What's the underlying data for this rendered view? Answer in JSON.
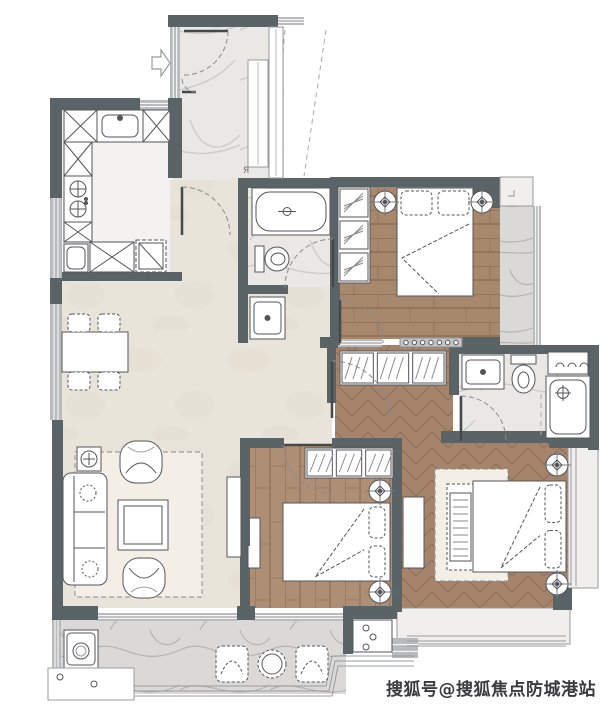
{
  "watermark": {
    "text": "搜狐号@搜狐焦点防城港站",
    "x": 386,
    "y": 695,
    "size": 17,
    "color": "#3a3a3e"
  },
  "label_ya": {
    "text": "Я",
    "x": 243,
    "y": 173,
    "size": 9,
    "color": "#6a6b6d"
  },
  "palette": {
    "wall": "#5a6467",
    "wallLight": "#b9babb",
    "stroke": "#55565a",
    "doorArc": "#8a8b8d",
    "dash": "#a9aaac",
    "white": "#ffffff",
    "beige": "#e9e4da",
    "kitchenFloor": "#f3f2f1",
    "sillFill": "#f1efed"
  },
  "plan": {
    "width": 603,
    "height": 707,
    "floors": [
      {
        "name": "entry-hall-floor",
        "kind": "marble",
        "x": 172,
        "y": 27,
        "w": 112,
        "h": 155
      },
      {
        "name": "living-dining-floor",
        "kind": "beige",
        "x": 62,
        "y": 180,
        "w": 270,
        "h": 428
      },
      {
        "name": "kitchen-floor",
        "kind": "kitchen",
        "x": 62,
        "y": 107,
        "w": 108,
        "h": 167
      },
      {
        "name": "bath-main-floor",
        "kind": "marble",
        "x": 248,
        "y": 186,
        "w": 84,
        "h": 101
      },
      {
        "name": "bedroom1-floor",
        "kind": "wood_h",
        "x": 338,
        "y": 185,
        "w": 162,
        "h": 154
      },
      {
        "name": "bedroom1-balcony-floor",
        "kind": "marble_gray",
        "x": 500,
        "y": 206,
        "w": 34,
        "h": 139
      },
      {
        "name": "corridor-floor",
        "kind": "herringbone",
        "x": 335,
        "y": 345,
        "w": 118,
        "h": 95
      },
      {
        "name": "master-bath-floor",
        "kind": "marble",
        "x": 459,
        "y": 352,
        "w": 130,
        "h": 88
      },
      {
        "name": "master-bedroom-floor",
        "kind": "herringbone",
        "x": 397,
        "y": 440,
        "w": 173,
        "h": 170
      },
      {
        "name": "bedroom2-floor",
        "kind": "wood_v",
        "x": 248,
        "y": 446,
        "w": 146,
        "h": 162
      },
      {
        "name": "balcony-floor",
        "kind": "marble_gray",
        "x": 60,
        "y": 618,
        "w": 286,
        "h": 76
      },
      {
        "name": "bay-window-bottom",
        "kind": "sillfloor",
        "x": 397,
        "y": 608,
        "w": 173,
        "h": 36
      },
      {
        "name": "bay-window-right",
        "kind": "sillfloor",
        "x": 568,
        "y": 446,
        "w": 30,
        "h": 142
      }
    ],
    "walls": [
      [
        168,
        15,
        110,
        12
      ],
      [
        50,
        98,
        90,
        12
      ],
      [
        50,
        110,
        12,
        88
      ],
      [
        50,
        278,
        12,
        26
      ],
      [
        52,
        420,
        11,
        200
      ],
      [
        52,
        606,
        46,
        14
      ],
      [
        237,
        606,
        18,
        14
      ],
      [
        343,
        606,
        54,
        13
      ],
      [
        343,
        606,
        10,
        48
      ],
      [
        168,
        98,
        14,
        80
      ],
      [
        62,
        272,
        120,
        9
      ],
      [
        238,
        178,
        96,
        10
      ],
      [
        238,
        186,
        10,
        102
      ],
      [
        238,
        285,
        50,
        9
      ],
      [
        238,
        285,
        10,
        58
      ],
      [
        330,
        177,
        10,
        168
      ],
      [
        340,
        177,
        133,
        10
      ],
      [
        473,
        177,
        27,
        31
      ],
      [
        320,
        337,
        18,
        11
      ],
      [
        460,
        337,
        40,
        11
      ],
      [
        327,
        348,
        9,
        55
      ],
      [
        240,
        438,
        44,
        10
      ],
      [
        332,
        438,
        65,
        10
      ],
      [
        240,
        448,
        10,
        160
      ],
      [
        392,
        438,
        10,
        174
      ],
      [
        441,
        431,
        110,
        12
      ],
      [
        449,
        345,
        10,
        50
      ],
      [
        449,
        345,
        142,
        9
      ],
      [
        588,
        345,
        11,
        105
      ],
      [
        549,
        438,
        50,
        10
      ],
      [
        553,
        588,
        19,
        22
      ]
    ],
    "lightWalls": [
      [
        278,
        17,
        26,
        8
      ],
      [
        138,
        100,
        38,
        10
      ],
      [
        50,
        198,
        12,
        80
      ],
      [
        50,
        304,
        12,
        116
      ],
      [
        97,
        613,
        140,
        8
      ],
      [
        253,
        613,
        90,
        8
      ],
      [
        533,
        206,
        8,
        139
      ],
      [
        338,
        339,
        44,
        8
      ],
      [
        392,
        638,
        26,
        20
      ],
      [
        52,
        620,
        9,
        56
      ],
      [
        170,
        27,
        10,
        71
      ]
    ],
    "glass": [
      "M407,636 H566",
      "M407,641 H566",
      "M407,646 H566",
      "M571,448 V586",
      "M576,448 V586"
    ],
    "railings": [
      "M55,686 L326,686 L332,656 L414,656",
      "M55,691 L329,691 L335,661 L414,661",
      "M55,696 L332,696 L338,666 L414,666"
    ],
    "doors": [
      {
        "name": "entry-door",
        "leaf": [
          184,
          31,
          228,
          31
        ],
        "arc": "M228,31 A44,44 0 0 1 184,75"
      },
      {
        "name": "entry-door-leaf2",
        "leaf": [
          182,
          92,
          196,
          92
        ],
        "arc": "M196,92 A14,14 0 0 1 182,78"
      },
      {
        "name": "kitchen-door",
        "leaf": [
          182,
          235,
          182,
          187
        ],
        "arc": "M182,187 A48,48 0 0 1 230,235"
      },
      {
        "name": "bath-door",
        "leaf": [
          333,
          287,
          333,
          239
        ],
        "arc": "M333,239 A48,48 0 0 0 285,287"
      },
      {
        "name": "bedroom1-door",
        "leaf": [
          340,
          343,
          340,
          300
        ],
        "arc": "M340,300 A43,43 0 0 1 383,343"
      },
      {
        "name": "corridor-door",
        "leaf": [
          332,
          418,
          332,
          361
        ],
        "arc": "M332,361 A57,57 0 0 1 389,418"
      },
      {
        "name": "bedroom2-door",
        "leaf": [
          332,
          445,
          284,
          445
        ],
        "arc": "M284,445 A48,48 0 0 0 332,493"
      },
      {
        "name": "master-bath-door",
        "leaf": [
          461,
          441,
          461,
          396
        ],
        "arc": "M461,396 A45,45 0 0 1 506,441"
      }
    ],
    "dashes": [
      [
        285,
        30,
        272,
        176
      ],
      [
        326,
        30,
        304,
        176
      ],
      [
        541,
        394,
        541,
        438
      ]
    ],
    "arrow": {
      "name": "entry-arrow",
      "points": "152,57 161,57 161,50 170,63 161,76 161,69 152,69"
    },
    "plants": [
      {
        "cx": 385,
        "cy": 202
      },
      {
        "cx": 482,
        "cy": 202
      },
      {
        "cx": 557,
        "cy": 465
      },
      {
        "cx": 557,
        "cy": 584
      },
      {
        "cx": 380,
        "cy": 491
      },
      {
        "cx": 380,
        "cy": 592
      }
    ],
    "furniture": [
      {
        "type": "xcab",
        "name": "kitchen-counter",
        "x": 64,
        "y": 110,
        "w": 33,
        "h": 32
      },
      {
        "type": "ksink",
        "name": "kitchen-sink",
        "x": 97,
        "y": 110,
        "w": 46,
        "h": 32
      },
      {
        "type": "xcab",
        "name": "kitchen-counter",
        "x": 143,
        "y": 110,
        "w": 27,
        "h": 32
      },
      {
        "type": "xcab",
        "name": "kitchen-counter",
        "x": 64,
        "y": 142,
        "w": 28,
        "h": 34
      },
      {
        "type": "stove",
        "name": "stove",
        "x": 64,
        "y": 176,
        "w": 28,
        "h": 46
      },
      {
        "type": "xcab",
        "name": "kitchen-counter",
        "x": 64,
        "y": 222,
        "w": 28,
        "h": 20
      },
      {
        "type": "appl",
        "name": "dishwasher",
        "x": 64,
        "y": 244,
        "w": 24,
        "h": 28
      },
      {
        "type": "xcab",
        "name": "kitchen-counter",
        "x": 90,
        "y": 242,
        "w": 44,
        "h": 30
      },
      {
        "type": "fridge",
        "name": "fridge",
        "x": 136,
        "y": 240,
        "w": 30,
        "h": 32
      },
      {
        "type": "cab",
        "name": "shoe-cabinet",
        "x": 248,
        "y": 60,
        "w": 20,
        "h": 107
      },
      {
        "type": "cab",
        "name": "entry-cabinet",
        "x": 269,
        "y": 27,
        "w": 14,
        "h": 151
      },
      {
        "type": "tub",
        "name": "bathtub",
        "x": 252,
        "y": 188,
        "w": 78,
        "h": 47
      },
      {
        "type": "toiletR",
        "name": "toilet",
        "x": 255,
        "y": 244,
        "w": 33,
        "h": 30
      },
      {
        "type": "vanity",
        "name": "washbasin",
        "x": 250,
        "y": 297,
        "w": 35,
        "h": 42
      },
      {
        "type": "wardV",
        "name": "bedroom1-wardrobe",
        "x": 338,
        "y": 187,
        "w": 32,
        "h": 96,
        "cells": 3
      },
      {
        "type": "bedT",
        "name": "bedroom1-bed",
        "x": 397,
        "y": 188,
        "w": 76,
        "h": 108
      },
      {
        "type": "track",
        "name": "sliding-door",
        "x": 400,
        "y": 338,
        "w": 62,
        "h": 9,
        "dots": 7
      },
      {
        "type": "sill",
        "name": "window-sill",
        "x": 500,
        "y": 177,
        "w": 33,
        "h": 29
      },
      {
        "type": "wardH",
        "name": "corridor-wardrobe",
        "x": 340,
        "y": 351,
        "w": 106,
        "h": 34,
        "cells": 3
      },
      {
        "type": "vanity",
        "name": "master-washbasin",
        "x": 462,
        "y": 355,
        "w": 42,
        "h": 34
      },
      {
        "type": "toiletD",
        "name": "master-toilet",
        "x": 511,
        "y": 355,
        "w": 25,
        "h": 40
      },
      {
        "type": "shelf",
        "name": "towel-shelf",
        "x": 548,
        "y": 352,
        "w": 40,
        "h": 22
      },
      {
        "type": "shower",
        "name": "shower",
        "x": 546,
        "y": 376,
        "w": 44,
        "h": 62
      },
      {
        "type": "rug",
        "name": "master-rug",
        "x": 435,
        "y": 469,
        "w": 73,
        "h": 112
      },
      {
        "type": "crib",
        "name": "crib",
        "x": 447,
        "y": 484,
        "w": 27,
        "h": 86
      },
      {
        "type": "bedR",
        "name": "master-bed",
        "x": 473,
        "y": 481,
        "w": 93,
        "h": 91
      },
      {
        "type": "consoleV",
        "name": "master-tv-console",
        "x": 403,
        "y": 497,
        "w": 21,
        "h": 71
      },
      {
        "type": "wardH",
        "name": "bedroom2-wardrobe",
        "x": 305,
        "y": 448,
        "w": 88,
        "h": 30,
        "cells": 3
      },
      {
        "type": "bedR",
        "name": "bedroom2-bed",
        "x": 283,
        "y": 503,
        "w": 107,
        "h": 78
      },
      {
        "type": "consoleV",
        "name": "bedroom2-tv",
        "x": 248,
        "y": 518,
        "w": 12,
        "h": 50
      },
      {
        "type": "table",
        "name": "dining-table",
        "x": 62,
        "y": 332,
        "w": 66,
        "h": 40
      },
      {
        "type": "chair",
        "name": "dining-chair",
        "x": 68,
        "y": 314,
        "w": 22,
        "h": 18
      },
      {
        "type": "chair",
        "name": "dining-chair",
        "x": 98,
        "y": 314,
        "w": 22,
        "h": 18
      },
      {
        "type": "chair",
        "name": "dining-chair",
        "x": 68,
        "y": 372,
        "w": 22,
        "h": 18
      },
      {
        "type": "chair",
        "name": "dining-chair",
        "x": 98,
        "y": 372,
        "w": 22,
        "h": 18
      },
      {
        "type": "rug",
        "name": "living-rug",
        "x": 75,
        "y": 452,
        "w": 127,
        "h": 145
      },
      {
        "type": "sidetable",
        "name": "side-table",
        "x": 77,
        "y": 447,
        "w": 24,
        "h": 24
      },
      {
        "type": "sofa",
        "name": "sofa",
        "x": 63,
        "y": 473,
        "w": 44,
        "h": 112
      },
      {
        "type": "armchairD",
        "name": "armchair",
        "x": 120,
        "y": 441,
        "w": 42,
        "h": 42
      },
      {
        "type": "armchairU",
        "name": "armchair",
        "x": 123,
        "y": 558,
        "w": 42,
        "h": 40
      },
      {
        "type": "coffee",
        "name": "coffee-table",
        "x": 118,
        "y": 500,
        "w": 50,
        "h": 50
      },
      {
        "type": "consoleV",
        "name": "tv-console",
        "x": 227,
        "y": 477,
        "w": 14,
        "h": 80
      },
      {
        "type": "tv",
        "name": "tv",
        "x": 245,
        "y": 498,
        "w": 5,
        "h": 48
      },
      {
        "type": "washer",
        "name": "washing-machine",
        "x": 64,
        "y": 630,
        "w": 34,
        "h": 38
      },
      {
        "type": "lounge",
        "name": "balcony-chair",
        "x": 216,
        "y": 646,
        "w": 32,
        "h": 36
      },
      {
        "type": "lounge",
        "name": "balcony-chair",
        "x": 296,
        "y": 646,
        "w": 32,
        "h": 36
      },
      {
        "type": "rtable",
        "name": "balcony-table",
        "cx": 272,
        "cy": 664,
        "r": 14
      },
      {
        "type": "acplat",
        "name": "ac-platform",
        "x": 48,
        "y": 668,
        "w": 86,
        "h": 32
      },
      {
        "type": "acunit",
        "name": "ac-unit",
        "x": 353,
        "y": 620,
        "w": 39,
        "h": 32
      }
    ]
  }
}
